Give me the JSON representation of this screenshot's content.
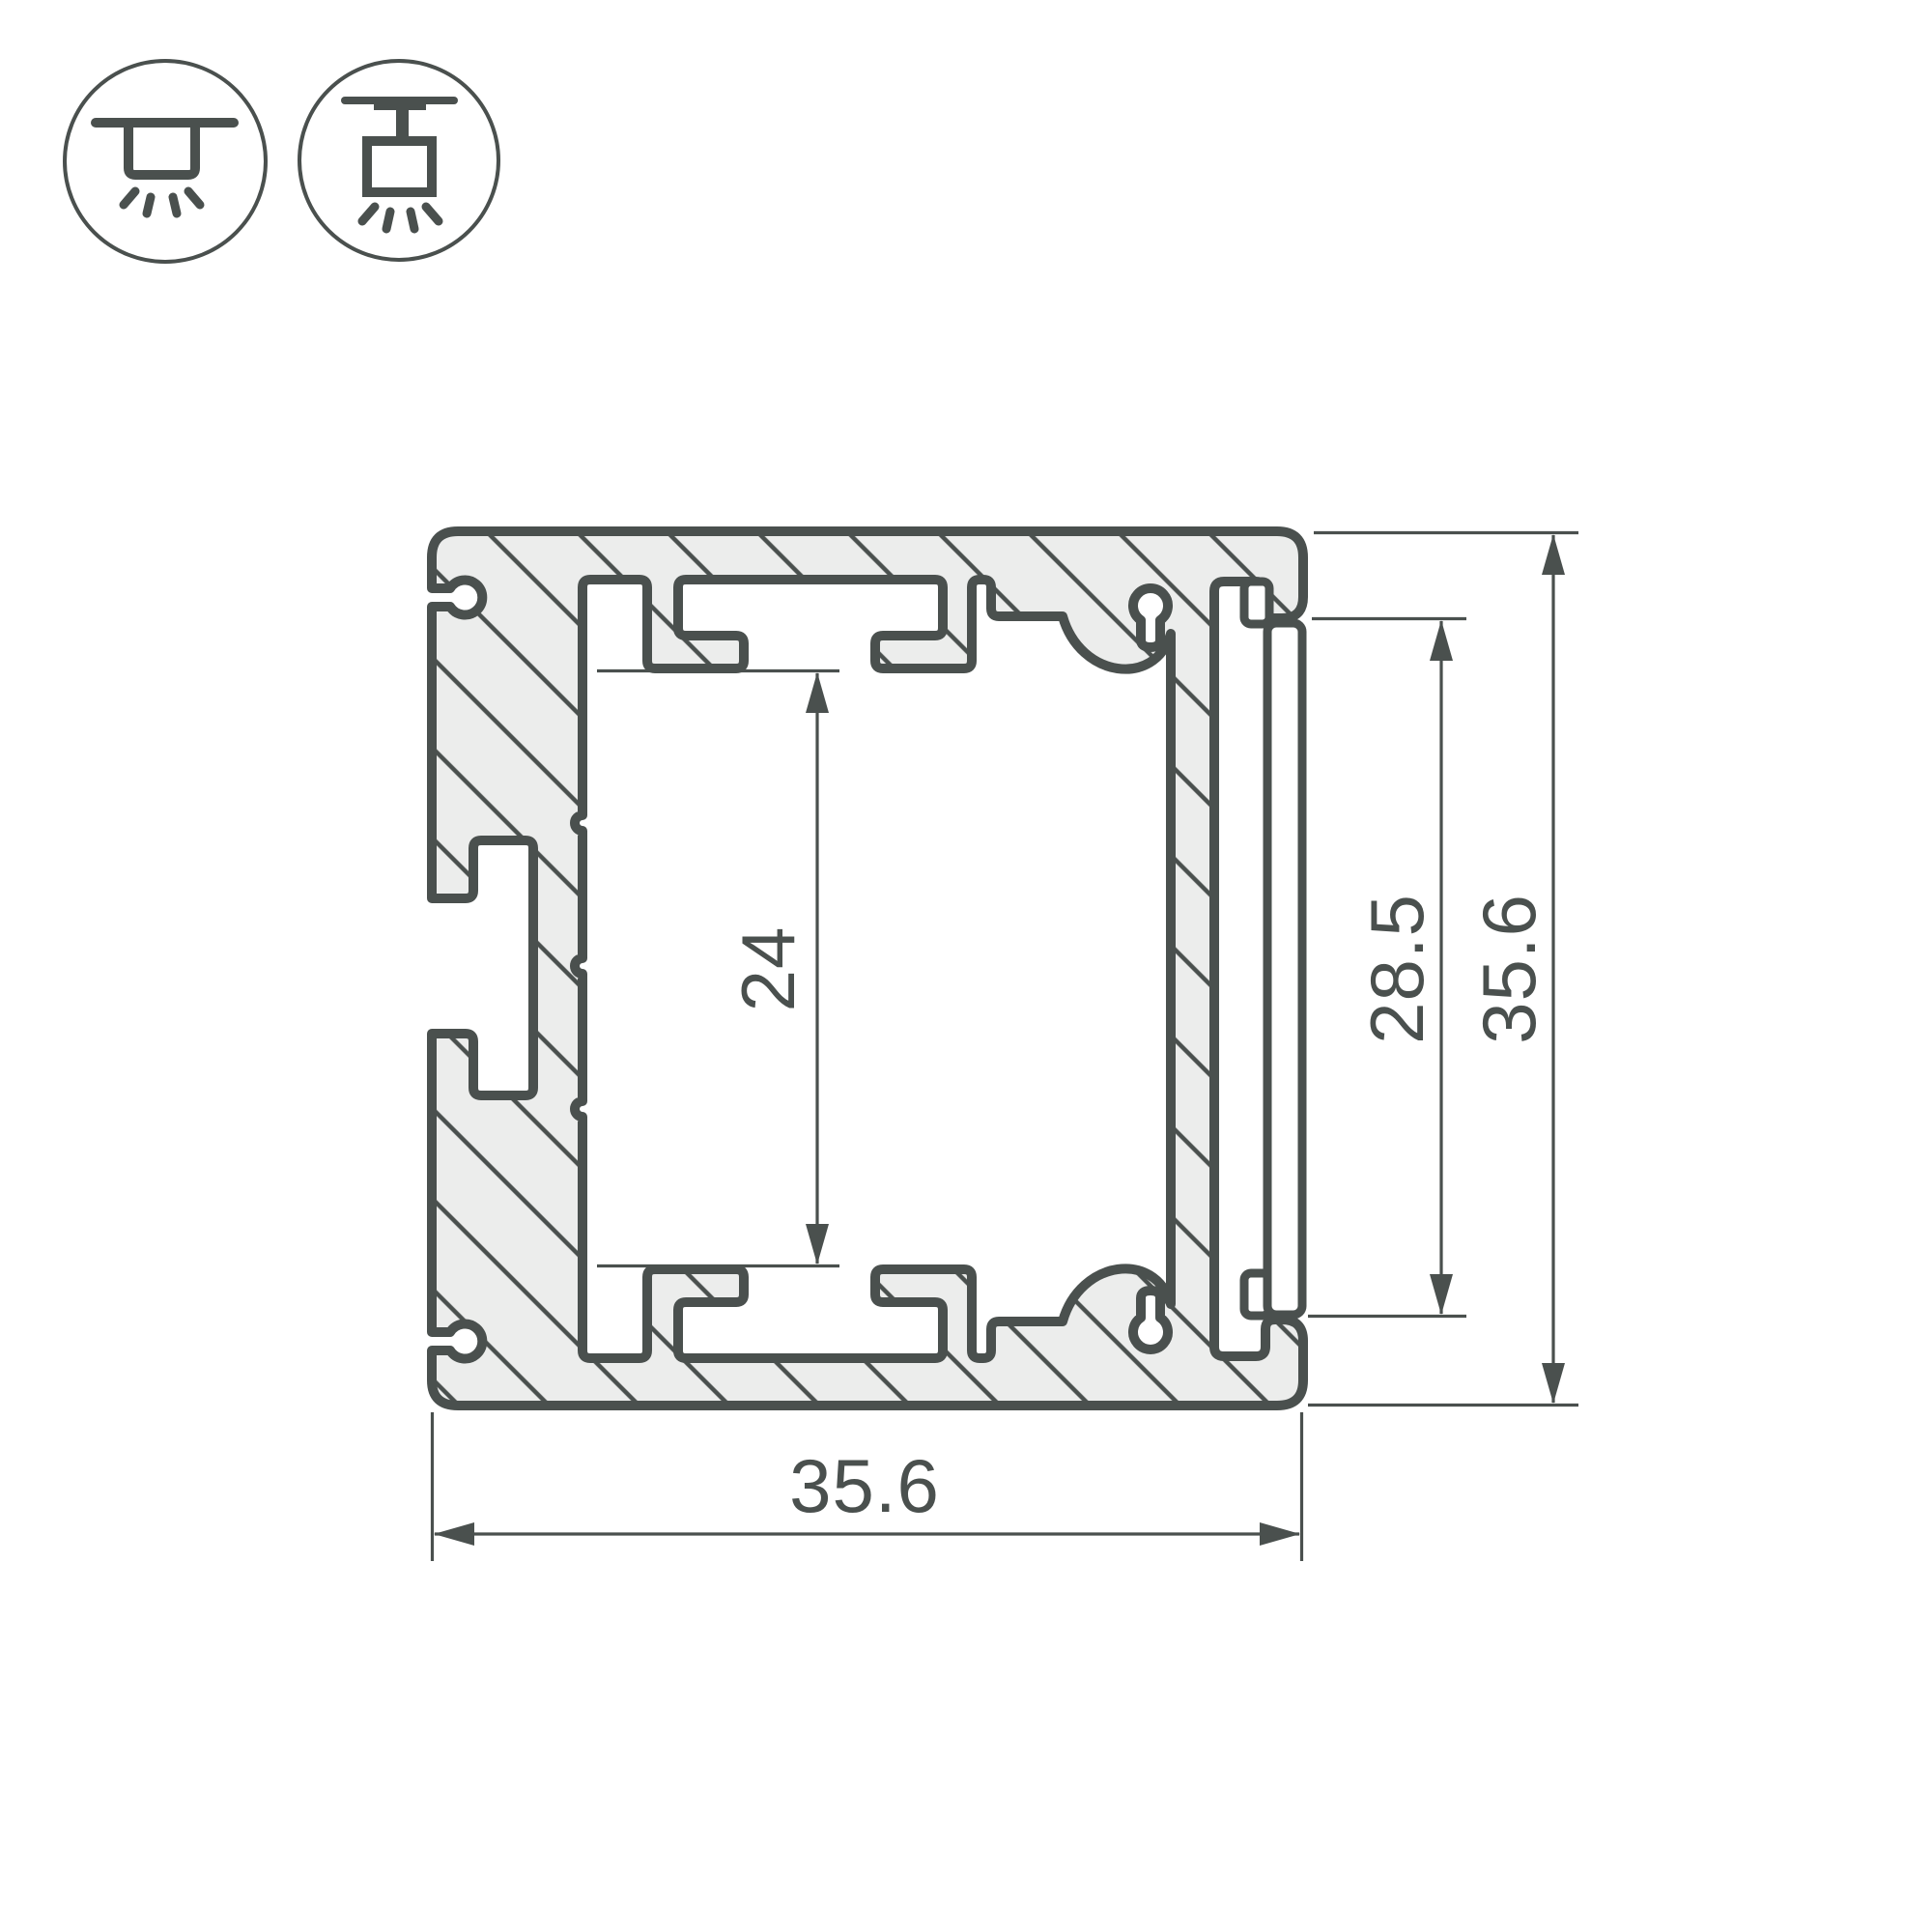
{
  "drawing": {
    "type": "profile-cross-section",
    "icons": [
      {
        "name": "surface-mount-icon",
        "meaning": "surface ceiling mount luminaire, light downward"
      },
      {
        "name": "pendant-mount-icon",
        "meaning": "suspended / pendant mount luminaire, light downward"
      }
    ],
    "dimensions": {
      "inner_cavity_height": "24",
      "diffuser_opening_height": "28.5",
      "overall_height": "35.6",
      "overall_width": "35.6"
    },
    "colors": {
      "ink": "#4a504e",
      "aluminum_fill": "#ecedec",
      "background": "#ffffff"
    }
  }
}
